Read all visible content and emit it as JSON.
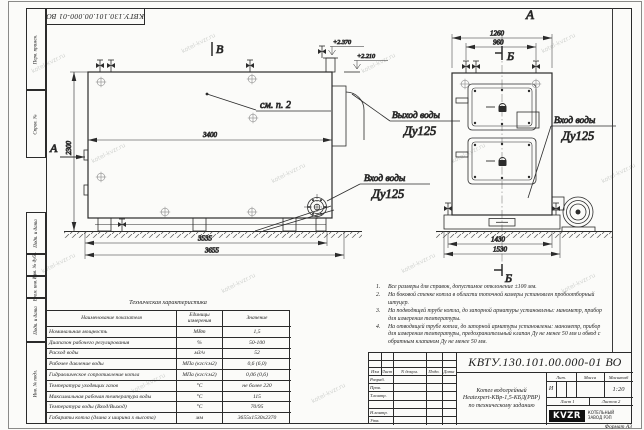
{
  "watermark": {
    "text": "kotel-kvzr.ru"
  },
  "frame": {
    "doc_number": "КВТУ.130.101.00.000-01 ВО",
    "format": "Формат А3",
    "margins": {
      "m1": "Перв. примен.",
      "m2": "Справ. №",
      "m3": "Подп. и дата",
      "m4": "Инв. № дубл.",
      "m5": "Взам. инв. №",
      "m6": "Подп. и дата",
      "m7": "Инв. № подл."
    }
  },
  "drawing": {
    "views": {
      "a": "А",
      "b": "В",
      "sec": "Б"
    },
    "see": "см. п. 2",
    "labels": {
      "outlet1": "Выход воды",
      "outlet2": "Ду125",
      "inlet1": "Вход воды",
      "inlet2": "Ду125"
    },
    "elev": {
      "e1": "+2.370",
      "e2": "+2.210"
    },
    "dims": {
      "w3400": "3400",
      "h2300": "2300",
      "w3535": "3535",
      "w3655": "3655",
      "w1260": "1260",
      "w960": "960",
      "w1430": "1430",
      "w1530": "1530"
    }
  },
  "table": {
    "title": "Техническая характеристика",
    "headers": {
      "name": "Наименование показателя",
      "units": "Единицы измерения",
      "value": "Значение"
    },
    "rows": [
      {
        "n": "Номинальная мощность",
        "u": "МВт",
        "v": "1,5"
      },
      {
        "n": "Диапазон рабочего регулирования",
        "u": "%",
        "v": "50-100"
      },
      {
        "n": "Расход воды",
        "u": "м3/ч",
        "v": "52"
      },
      {
        "n": "Рабочее давление воды",
        "u": "МПа (кгс/см2)",
        "v": "0,6 (6,0)"
      },
      {
        "n": "Гидравлическое сопротивление котла",
        "u": "МПа (кгс/см2)",
        "v": "0,06 (0,6)"
      },
      {
        "n": "Температура уходящих газов",
        "u": "°С",
        "v": "не более 220"
      },
      {
        "n": "Максимальная рабочая температура воды",
        "u": "°С",
        "v": "115"
      },
      {
        "n": "Температура воды (Вход/Выход)",
        "u": "°С",
        "v": "70/95"
      },
      {
        "n": "Габариты котла (длина х ширина х высота)",
        "u": "мм",
        "v": "3655х1530х2370"
      }
    ]
  },
  "notes": {
    "n1": {
      "num": "1.",
      "text": "Все размеры для справок, допустимое отклонение ±100 мм."
    },
    "n2": {
      "num": "2.",
      "text": "На боковой стенке котла в области топочной камеры установлен пробоотборный штуцер."
    },
    "n3": {
      "num": "3.",
      "text": "На подводящей трубе котла, до запорной арматуры установлены: манометр, прибор для измерения температуры."
    },
    "n4": {
      "num": "4.",
      "text": "На отводящей трубе котла, до запорной арматуры установлены: манометр, прибор для измерения температуры, предохранительный клапан Ду не менее 50 мм и обвод с обратным клапаном Ду не менее 50 мм."
    }
  },
  "title_block": {
    "doc_number": "КВТУ.130.101.00.000-01 ВО",
    "name1": "Котел водогрейный",
    "name2": "Heatexpert-КВр-1,5-КБД(РВР)",
    "name3": "по техническому заданию",
    "lit_header": "Лит.",
    "mass_header": "Масса",
    "scale_header": "Масштаб",
    "lit": "И",
    "scale": "1:20",
    "sheet": "Лист 1",
    "sheets": "Листов 2",
    "cols": {
      "izm": "Изм",
      "list": "Лист",
      "ndoc": "N докум.",
      "podp": "Подп.",
      "data": "Дата"
    },
    "roles": {
      "r1": "Разраб.",
      "r2": "Пров.",
      "r3": "Т.контр.",
      "r4": "",
      "r5": "Н.контр.",
      "r6": "Утв."
    },
    "logo": "KVZR",
    "logo_sub1": "КОТЕЛЬНЫЙ",
    "logo_sub2": "ЗАВОД РЭП"
  }
}
